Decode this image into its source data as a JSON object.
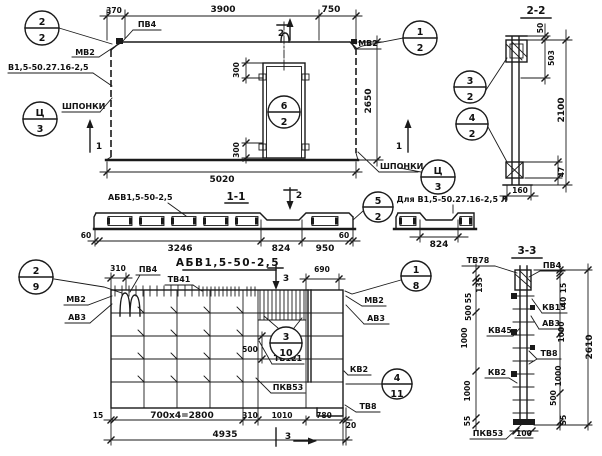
{
  "views": {
    "elevation": {
      "dims": {
        "d370": "370",
        "d3900": "3900",
        "d750": "750",
        "d5020": "5020",
        "d2650": "2650",
        "door_top": "300",
        "door_bottom": "300"
      },
      "labels": {
        "pv4": "ПВ4",
        "mv2_left": "МВ2",
        "mv2_right": "МВ2",
        "product_mark": "В1,5-50.27.16-2,5",
        "keys_left": "ШПОНКИ",
        "keys_right": "ШПОНКИ"
      },
      "callouts": {
        "top_left": {
          "num": "2",
          "sheet": "2"
        },
        "top_right": {
          "num": "1",
          "sheet": "2"
        },
        "keys_left": {
          "num": "Ц",
          "sheet": "3"
        },
        "keys_right": {
          "num": "Ц",
          "sheet": "3"
        },
        "door": {
          "num": "6",
          "sheet": "2"
        }
      },
      "section_marks": {
        "s1_left": "1",
        "s1_right": "1",
        "s2_top": "2"
      }
    },
    "section_2_2": {
      "title": "2-2",
      "dims": {
        "d50": "50",
        "d503": "503",
        "d2100": "2100",
        "d160": "160",
        "d47": "47"
      },
      "callouts": {
        "upper": {
          "num": "3",
          "sheet": "2"
        },
        "lower": {
          "num": "4",
          "sheet": "2"
        }
      }
    },
    "section_1_1": {
      "title": "1-1",
      "product_mark": "АБВ1,5-50-2,5",
      "section_mark": "2",
      "callout": {
        "num": "5",
        "sheet": "2"
      },
      "dims": {
        "d60_left": "60",
        "d3246": "3246",
        "d824": "824",
        "d950": "950",
        "d60_right": "60"
      }
    },
    "strip_left_version": {
      "label": "Для В1,5-50.27.16-2,5 Л",
      "dims": {
        "d824": "824"
      }
    },
    "reinforcement": {
      "title": "АБВ1,5-50-2,5",
      "labels": {
        "pv4": "ПВ4",
        "tv41": "ТВ41",
        "mv2_left": "МВ2",
        "av3_left": "АВ3",
        "mv2_right": "МВ2",
        "av3_right": "АВ3",
        "tv121": "ТВ121",
        "kv2": "КВ2",
        "pkv53": "ПКВ53",
        "tv8": "ТВ8"
      },
      "dims": {
        "d310_top": "310",
        "d690": "690",
        "d500": "500",
        "d15": "15",
        "d700x4": "700x4=2800",
        "d310": "310",
        "d1010": "1010",
        "d780": "780",
        "d20": "20",
        "d4935": "4935"
      },
      "callouts": {
        "top_left": {
          "num": "2",
          "sheet": "9"
        },
        "top_right": {
          "num": "1",
          "sheet": "8"
        },
        "mesh": {
          "num": "3",
          "sheet": "10"
        },
        "right": {
          "num": "4",
          "sheet": "11"
        }
      },
      "section_marks": {
        "s3_top": "3",
        "s3_bottom": "3"
      }
    },
    "section_3_3": {
      "title": "3-3",
      "labels": {
        "tv78": "ТВ78",
        "pv4": "ПВ4",
        "kv15": "КВ15",
        "av3": "АВ3",
        "kv45": "КВ45",
        "tv8": "ТВ8",
        "kv2": "КВ2",
        "pkv53": "ПКВ53"
      },
      "dims_left": [
        "135",
        "55",
        "500",
        "1000",
        "1000",
        "55"
      ],
      "dims_right": [
        "15",
        "40",
        "1000",
        "1000",
        "500",
        "55"
      ],
      "dims": {
        "total": "2610",
        "d100": "100"
      }
    }
  }
}
